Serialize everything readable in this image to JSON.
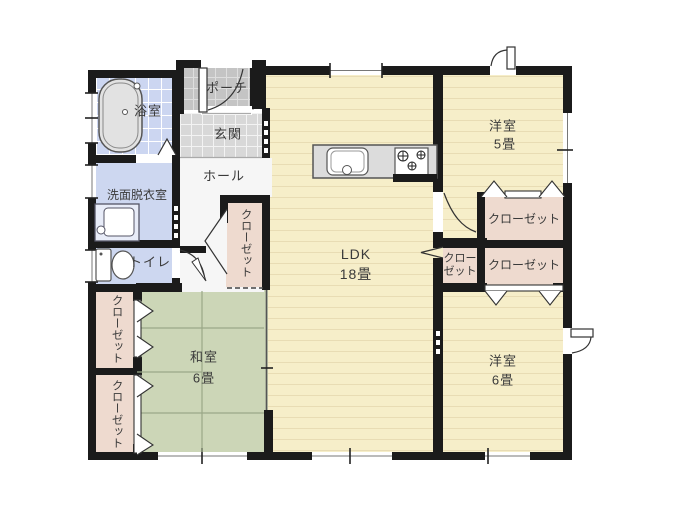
{
  "floor_plan": {
    "title": "house-floor-plan",
    "rooms": {
      "porch": {
        "label": "ポーチ"
      },
      "entrance": {
        "label": "玄関"
      },
      "hall": {
        "label": "ホール"
      },
      "bathroom": {
        "label": "浴室"
      },
      "washroom": {
        "label": "洗面脱衣室"
      },
      "toilet": {
        "label": "トイレ"
      },
      "japanese_room": {
        "label": "和室",
        "size": "6畳"
      },
      "ldk": {
        "label": "LDK",
        "size": "18畳"
      },
      "western_room_5": {
        "label": "洋室",
        "size": "5畳"
      },
      "western_room_6": {
        "label": "洋室",
        "size": "6畳"
      }
    },
    "closets": {
      "hall_closet": {
        "label": "クローゼット"
      },
      "west_closet_upper": {
        "label": "クローゼット"
      },
      "west_closet_lower": {
        "label": "クローゼット"
      },
      "closet_room5": {
        "label": "クローゼット"
      },
      "closet_small_ldk": {
        "label": "クローゼット"
      },
      "closet_room6": {
        "label": "クローゼット"
      }
    },
    "colors": {
      "wall": "#1b1b1b",
      "wood_floor": "#f6eec9",
      "wood_stripe": "#e8dcb4",
      "tatami": "#ccd6b7",
      "closet": "#eedacf",
      "wet_area": "#cdd7f0",
      "genkan_tile": "#d8d8d8",
      "porch_tile": "#c4c4c4",
      "hall_floor": "#f6f6f6",
      "text": "#3a3a3a"
    }
  }
}
